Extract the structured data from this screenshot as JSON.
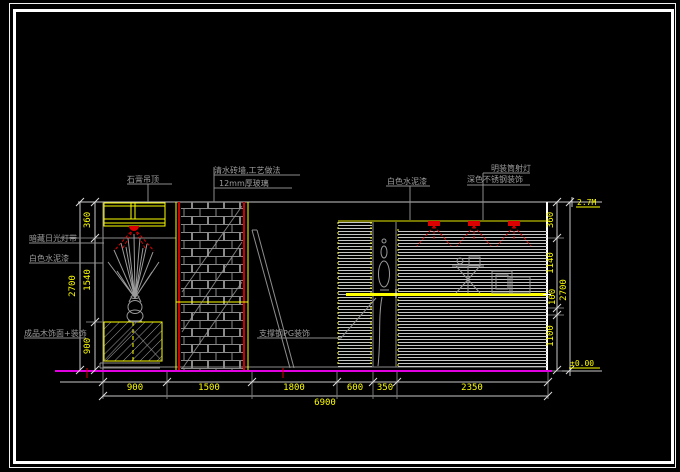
{
  "drawing": {
    "type": "interior-elevation-cad",
    "labels": {
      "ceiling": "石膏吊顶",
      "brick_wall": "清水砖墙,工艺做法",
      "glass": "12mm厚玻璃",
      "left_lamp": "暗藏日光灯带",
      "left_paint": "白色水泥漆",
      "left_cabinet": "成品木饰面+装饰",
      "support": "支撑钢PG装饰",
      "mid_paint": "白色水泥漆",
      "right_lamp": "明装筒射灯",
      "right_steel": "深色不锈钢装饰"
    },
    "dimensions": {
      "bottom": [
        "900",
        "1500",
        "1800",
        "600",
        "350",
        "2350"
      ],
      "bottom_total": "6900",
      "left": [
        "360",
        "1540",
        "900"
      ],
      "left_total": "2700",
      "right": [
        "360",
        "1140",
        "100",
        "1100"
      ],
      "right_total": "2700"
    },
    "levels": {
      "top": "2.7M",
      "bottom": "±0.00"
    },
    "colors": {
      "background": "#000000",
      "border": "#ffffff",
      "dimension_text": "#ffff00",
      "linework": "#9a9a9a",
      "accent_red": "#dd0000",
      "floor_line": "#e000e0"
    }
  }
}
